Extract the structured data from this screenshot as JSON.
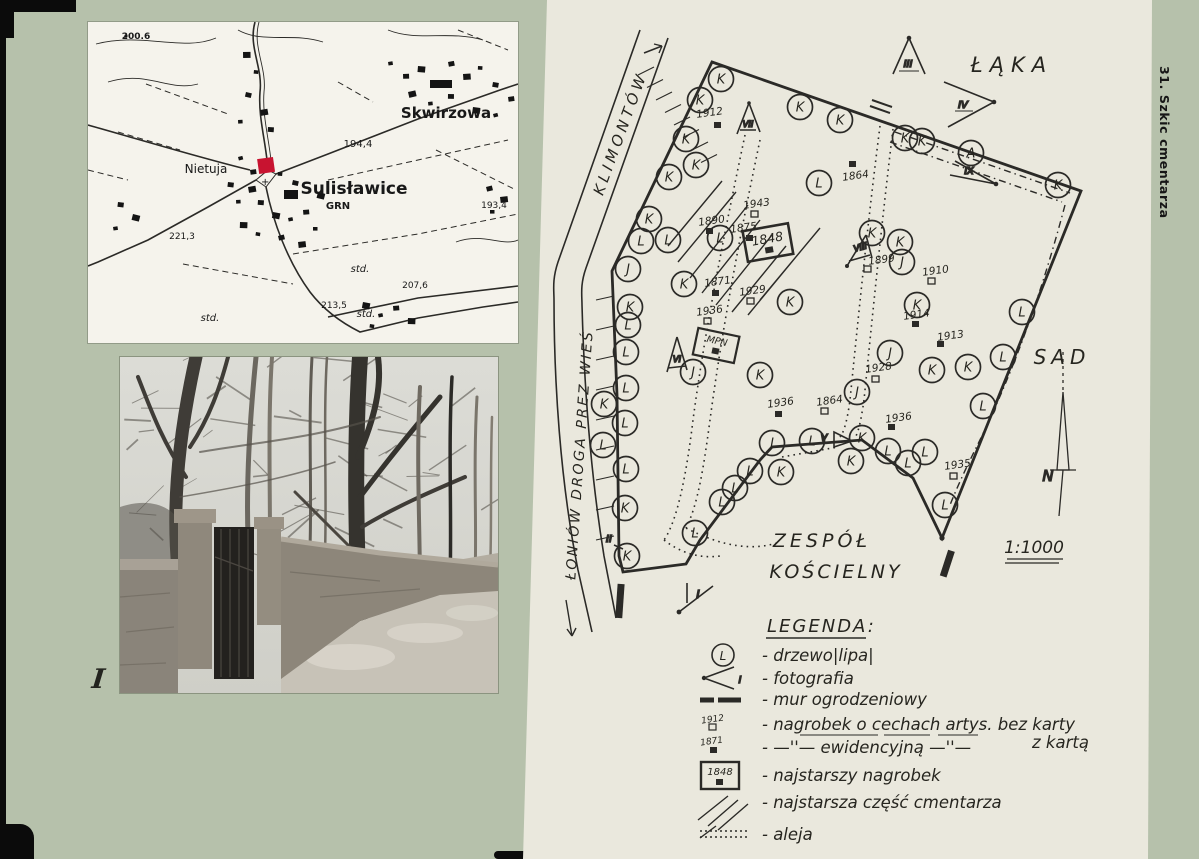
{
  "page": {
    "side_caption": "31. Szkic cmentarza"
  },
  "map": {
    "marker_color": "#c81330",
    "cross": "+",
    "labels": [
      {
        "t": "200.6",
        "x": 48,
        "y": 17,
        "s": 9,
        "b": 1
      },
      {
        "t": "Skwirzowa",
        "x": 358,
        "y": 96,
        "s": 15,
        "b": 1
      },
      {
        "t": "194,4",
        "x": 270,
        "y": 125,
        "s": 10
      },
      {
        "t": "Nietuja",
        "x": 118,
        "y": 151,
        "s": 12
      },
      {
        "t": "Sulisławice",
        "x": 266,
        "y": 172,
        "s": 17,
        "b": 1
      },
      {
        "t": "GRN",
        "x": 250,
        "y": 187,
        "s": 10,
        "b": 1
      },
      {
        "t": "193,4",
        "x": 406,
        "y": 186,
        "s": 9
      },
      {
        "t": "221,3",
        "x": 94,
        "y": 217,
        "s": 9
      },
      {
        "t": "std.",
        "x": 272,
        "y": 250,
        "s": 10,
        "i": 1
      },
      {
        "t": "207,6",
        "x": 327,
        "y": 266,
        "s": 9
      },
      {
        "t": "213,5",
        "x": 246,
        "y": 286,
        "s": 9
      },
      {
        "t": "std.",
        "x": 278,
        "y": 295,
        "s": 10,
        "i": 1
      },
      {
        "t": "std.",
        "x": 122,
        "y": 299,
        "s": 10,
        "i": 1
      }
    ]
  },
  "photo": {
    "label": "I"
  },
  "sketch": {
    "labels": {
      "klimontow": "KLIMONTÓW",
      "wies": "ŁONIÓW  DROGA  PREZ  WIEŚ",
      "laka": "ŁĄKA",
      "sad": "SAD",
      "zespol1": "ZESPÓŁ",
      "zespol2": "KOŚCIELNY",
      "scale": "1:1000",
      "north": "N",
      "mpn": "MPN",
      "oldest": "1848"
    },
    "markers": {
      "m1": "I",
      "m2": "II",
      "m3": "III",
      "m4": "IV",
      "m5": "V",
      "m6": "VI",
      "m7": "VII",
      "m8": "VIII",
      "m9": "IX"
    },
    "trees": [
      {
        "t": "K",
        "x": 721,
        "y": 79
      },
      {
        "t": "K",
        "x": 700,
        "y": 100
      },
      {
        "t": "K",
        "x": 686,
        "y": 139
      },
      {
        "t": "K",
        "x": 696,
        "y": 165
      },
      {
        "t": "K",
        "x": 669,
        "y": 177
      },
      {
        "t": "K",
        "x": 649,
        "y": 219
      },
      {
        "t": "L",
        "x": 668,
        "y": 240
      },
      {
        "t": "L",
        "x": 641,
        "y": 241
      },
      {
        "t": "J",
        "x": 628,
        "y": 269
      },
      {
        "t": "K",
        "x": 630,
        "y": 307
      },
      {
        "t": "L",
        "x": 628,
        "y": 325
      },
      {
        "t": "L",
        "x": 626,
        "y": 352
      },
      {
        "t": "L",
        "x": 626,
        "y": 388
      },
      {
        "t": "K",
        "x": 604,
        "y": 404
      },
      {
        "t": "L",
        "x": 625,
        "y": 423
      },
      {
        "t": "L",
        "x": 603,
        "y": 445
      },
      {
        "t": "L",
        "x": 626,
        "y": 469
      },
      {
        "t": "K",
        "x": 625,
        "y": 508
      },
      {
        "t": "K",
        "x": 627,
        "y": 556
      },
      {
        "t": "K",
        "x": 800,
        "y": 107
      },
      {
        "t": "K",
        "x": 840,
        "y": 120
      },
      {
        "t": "K",
        "x": 905,
        "y": 138
      },
      {
        "t": "K",
        "x": 922,
        "y": 141
      },
      {
        "t": "A",
        "x": 971,
        "y": 153
      },
      {
        "t": "K",
        "x": 1058,
        "y": 185
      },
      {
        "t": "L",
        "x": 819,
        "y": 183
      },
      {
        "t": "L",
        "x": 720,
        "y": 238
      },
      {
        "t": "K",
        "x": 684,
        "y": 284
      },
      {
        "t": "K",
        "x": 790,
        "y": 302
      },
      {
        "t": "K",
        "x": 872,
        "y": 233
      },
      {
        "t": "K",
        "x": 900,
        "y": 242
      },
      {
        "t": "J",
        "x": 902,
        "y": 262
      },
      {
        "t": "K",
        "x": 917,
        "y": 305
      },
      {
        "t": "L",
        "x": 1022,
        "y": 312
      },
      {
        "t": "L",
        "x": 1003,
        "y": 357
      },
      {
        "t": "K",
        "x": 932,
        "y": 370
      },
      {
        "t": "K",
        "x": 968,
        "y": 367
      },
      {
        "t": "J",
        "x": 890,
        "y": 353
      },
      {
        "t": "J",
        "x": 857,
        "y": 392
      },
      {
        "t": "K",
        "x": 760,
        "y": 375
      },
      {
        "t": "J",
        "x": 693,
        "y": 372
      },
      {
        "t": "L",
        "x": 983,
        "y": 406
      },
      {
        "t": "L",
        "x": 695,
        "y": 533
      },
      {
        "t": "L",
        "x": 722,
        "y": 502
      },
      {
        "t": "L",
        "x": 735,
        "y": 488
      },
      {
        "t": "L",
        "x": 750,
        "y": 471
      },
      {
        "t": "K",
        "x": 781,
        "y": 472
      },
      {
        "t": "J",
        "x": 772,
        "y": 443
      },
      {
        "t": "L",
        "x": 812,
        "y": 441
      },
      {
        "t": "K",
        "x": 862,
        "y": 438
      },
      {
        "t": "K",
        "x": 851,
        "y": 461
      },
      {
        "t": "L",
        "x": 888,
        "y": 451
      },
      {
        "t": "L",
        "x": 908,
        "y": 463
      },
      {
        "t": "L",
        "x": 925,
        "y": 452
      },
      {
        "t": "L",
        "x": 945,
        "y": 505
      }
    ],
    "graves": [
      {
        "t": "1912",
        "x": 710,
        "y": 116,
        "sx": 714,
        "sy": 122,
        "f": 1
      },
      {
        "t": "1864",
        "x": 856,
        "y": 179,
        "sx": 849,
        "sy": 161,
        "f": 1
      },
      {
        "t": "1943",
        "x": 757,
        "y": 207,
        "sx": 751,
        "sy": 211,
        "f": 0
      },
      {
        "t": "1890",
        "x": 712,
        "y": 224,
        "sx": 706,
        "sy": 228,
        "f": 1
      },
      {
        "t": "1875",
        "x": 744,
        "y": 231,
        "sx": 746,
        "sy": 235,
        "f": 1
      },
      {
        "t": "1871",
        "x": 718,
        "y": 285,
        "sx": 712,
        "sy": 290,
        "f": 1
      },
      {
        "t": "1929",
        "x": 753,
        "y": 294,
        "sx": 747,
        "sy": 298,
        "f": 0
      },
      {
        "t": "1936",
        "x": 710,
        "y": 314,
        "sx": 704,
        "sy": 318,
        "f": 0
      },
      {
        "t": "1899",
        "x": 882,
        "y": 263,
        "sx": 864,
        "sy": 266,
        "f": 0
      },
      {
        "t": "1910",
        "x": 936,
        "y": 274,
        "sx": 928,
        "sy": 278,
        "f": 0
      },
      {
        "t": "1914",
        "x": 917,
        "y": 318,
        "sx": 912,
        "sy": 321,
        "f": 1
      },
      {
        "t": "1913",
        "x": 951,
        "y": 339,
        "sx": 937,
        "sy": 341,
        "f": 1
      },
      {
        "t": "1928",
        "x": 879,
        "y": 371,
        "sx": 872,
        "sy": 376,
        "f": 0
      },
      {
        "t": "1936",
        "x": 781,
        "y": 406,
        "sx": 775,
        "sy": 411,
        "f": 1
      },
      {
        "t": "1864",
        "x": 830,
        "y": 404,
        "sx": 821,
        "sy": 408,
        "f": 0
      },
      {
        "t": "1936",
        "x": 899,
        "y": 421,
        "sx": 888,
        "sy": 424,
        "f": 1
      },
      {
        "t": "1935",
        "x": 958,
        "y": 468,
        "sx": 950,
        "sy": 473,
        "f": 0
      }
    ]
  },
  "legend": {
    "title": "LEGENDA:",
    "tree_letter": "L",
    "photo_sample": "I",
    "year_open": "1912",
    "year_filled": "1871",
    "year_oldest": "1848",
    "rows": {
      "tree": "- drzewo|lipa|",
      "photo": "- fotografia",
      "wall": "- mur ogrodzeniowy",
      "grave1": "- nagrobek o cechach artys. bez karty",
      "grave2": "- —''—  ewidencyjną  —''—",
      "grave2b": "z kartą",
      "oldest": "- najstarszy  nagrobek",
      "oldpart": "- najstarsza część cmentarza",
      "alley": "- aleja"
    }
  }
}
